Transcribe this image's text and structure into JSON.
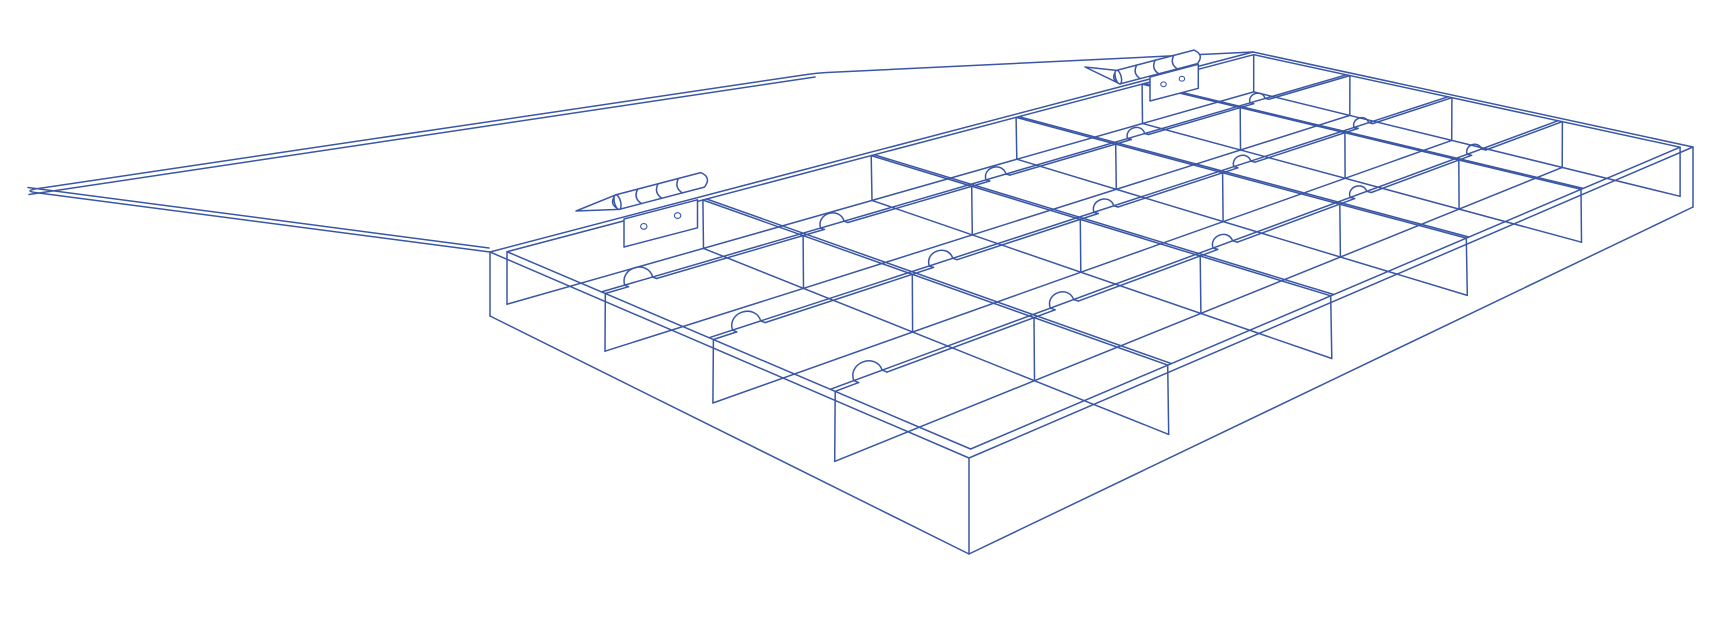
{
  "illustration": {
    "title": "open-compartment-box-line-drawing",
    "background": "#ffffff",
    "line_color": "#3a57a5",
    "line_width": 1.5,
    "canvas": {
      "width": 1734,
      "height": 624
    },
    "box": {
      "grid": {
        "columns": 5,
        "rows": 4,
        "compartments": 20
      },
      "top_corners": {
        "left": [
          490,
          252
        ],
        "back": [
          1253,
          52
        ],
        "right": [
          1693,
          147
        ],
        "front": [
          969,
          458
        ]
      },
      "bottom_corners": {
        "left": [
          490,
          316
        ],
        "back": [
          1253,
          97
        ],
        "right": [
          1693,
          207
        ],
        "front": [
          969,
          554
        ]
      },
      "wall_thickness": {
        "u": 0.01,
        "v": 0.016
      },
      "divider_thickness": {
        "u": 0.004,
        "v": 0.009
      },
      "floor_level": 0.82,
      "notch": {
        "offset_u": 0.034,
        "radius_u": 0.013,
        "height_factor": 0.95
      }
    },
    "lid": {
      "outline": [
        [
          490,
          252
        ],
        [
          35,
          192.5
        ],
        [
          25,
          191
        ],
        [
          35,
          189
        ],
        [
          807,
          74.5
        ],
        [
          817,
          73
        ],
        [
          827,
          72.5
        ],
        [
          1253,
          52
        ]
      ],
      "inner_bottom_edge": [
        [
          489,
          248
        ],
        [
          28,
          187.5
        ]
      ],
      "inner_top_edge": [
        [
          29,
          194.5
        ],
        [
          815,
          77
        ]
      ]
    },
    "hinges": [
      {
        "id": "hinge-left",
        "dir": [
          0.967,
          -0.253
        ],
        "barrel": {
          "center": [
            660,
            191
          ],
          "length": 88,
          "radius": 7.5,
          "knuckles": [
            0.26,
            0.5,
            0.74
          ]
        },
        "plate": {
          "top_left": [
            624,
            219
          ],
          "length": 76,
          "height": 28,
          "holes": [
            [
              0.27,
              0.45
            ],
            [
              0.73,
              0.38
            ]
          ],
          "hole_radius": 3.2
        },
        "wedge_tip": [
          576,
          211
        ]
      },
      {
        "id": "hinge-right",
        "dir": [
          0.967,
          -0.253
        ],
        "barrel": {
          "center": [
            1157,
            67
          ],
          "length": 80,
          "radius": 7,
          "knuckles": [
            0.26,
            0.5,
            0.74
          ]
        },
        "plate": {
          "top_left": [
            1150,
            77
          ],
          "length": 50,
          "height": 24,
          "holes": [
            [
              0.28,
              0.45
            ],
            [
              0.66,
              0.42
            ]
          ],
          "hole_radius": 2.7
        },
        "wedge_tip": [
          1085,
          67
        ]
      }
    ]
  }
}
